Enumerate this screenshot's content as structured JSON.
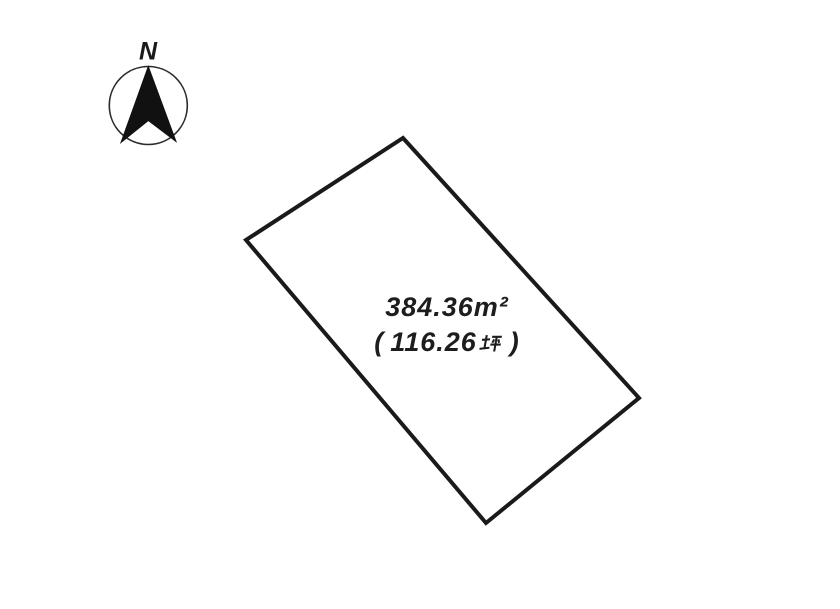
{
  "page": {
    "background": "#ffffff",
    "line_color": "#1a1a1a"
  },
  "compass": {
    "label": "N",
    "circle": {
      "cx": 148.3,
      "cy": 105.5,
      "r": 39
    },
    "arrow_points": "148.3,66.5 176,141.5 148.3,120.5 121,142.5"
  },
  "plot": {
    "boundary_points": "403,138 639,398 486,523 246,240",
    "area_m2": "384.36m²",
    "area_tsubo_full": "（116.26坪）",
    "tsubo_open": "(",
    "tsubo_value": "116.26",
    "tsubo_unit": "坪",
    "tsubo_close": ")"
  }
}
